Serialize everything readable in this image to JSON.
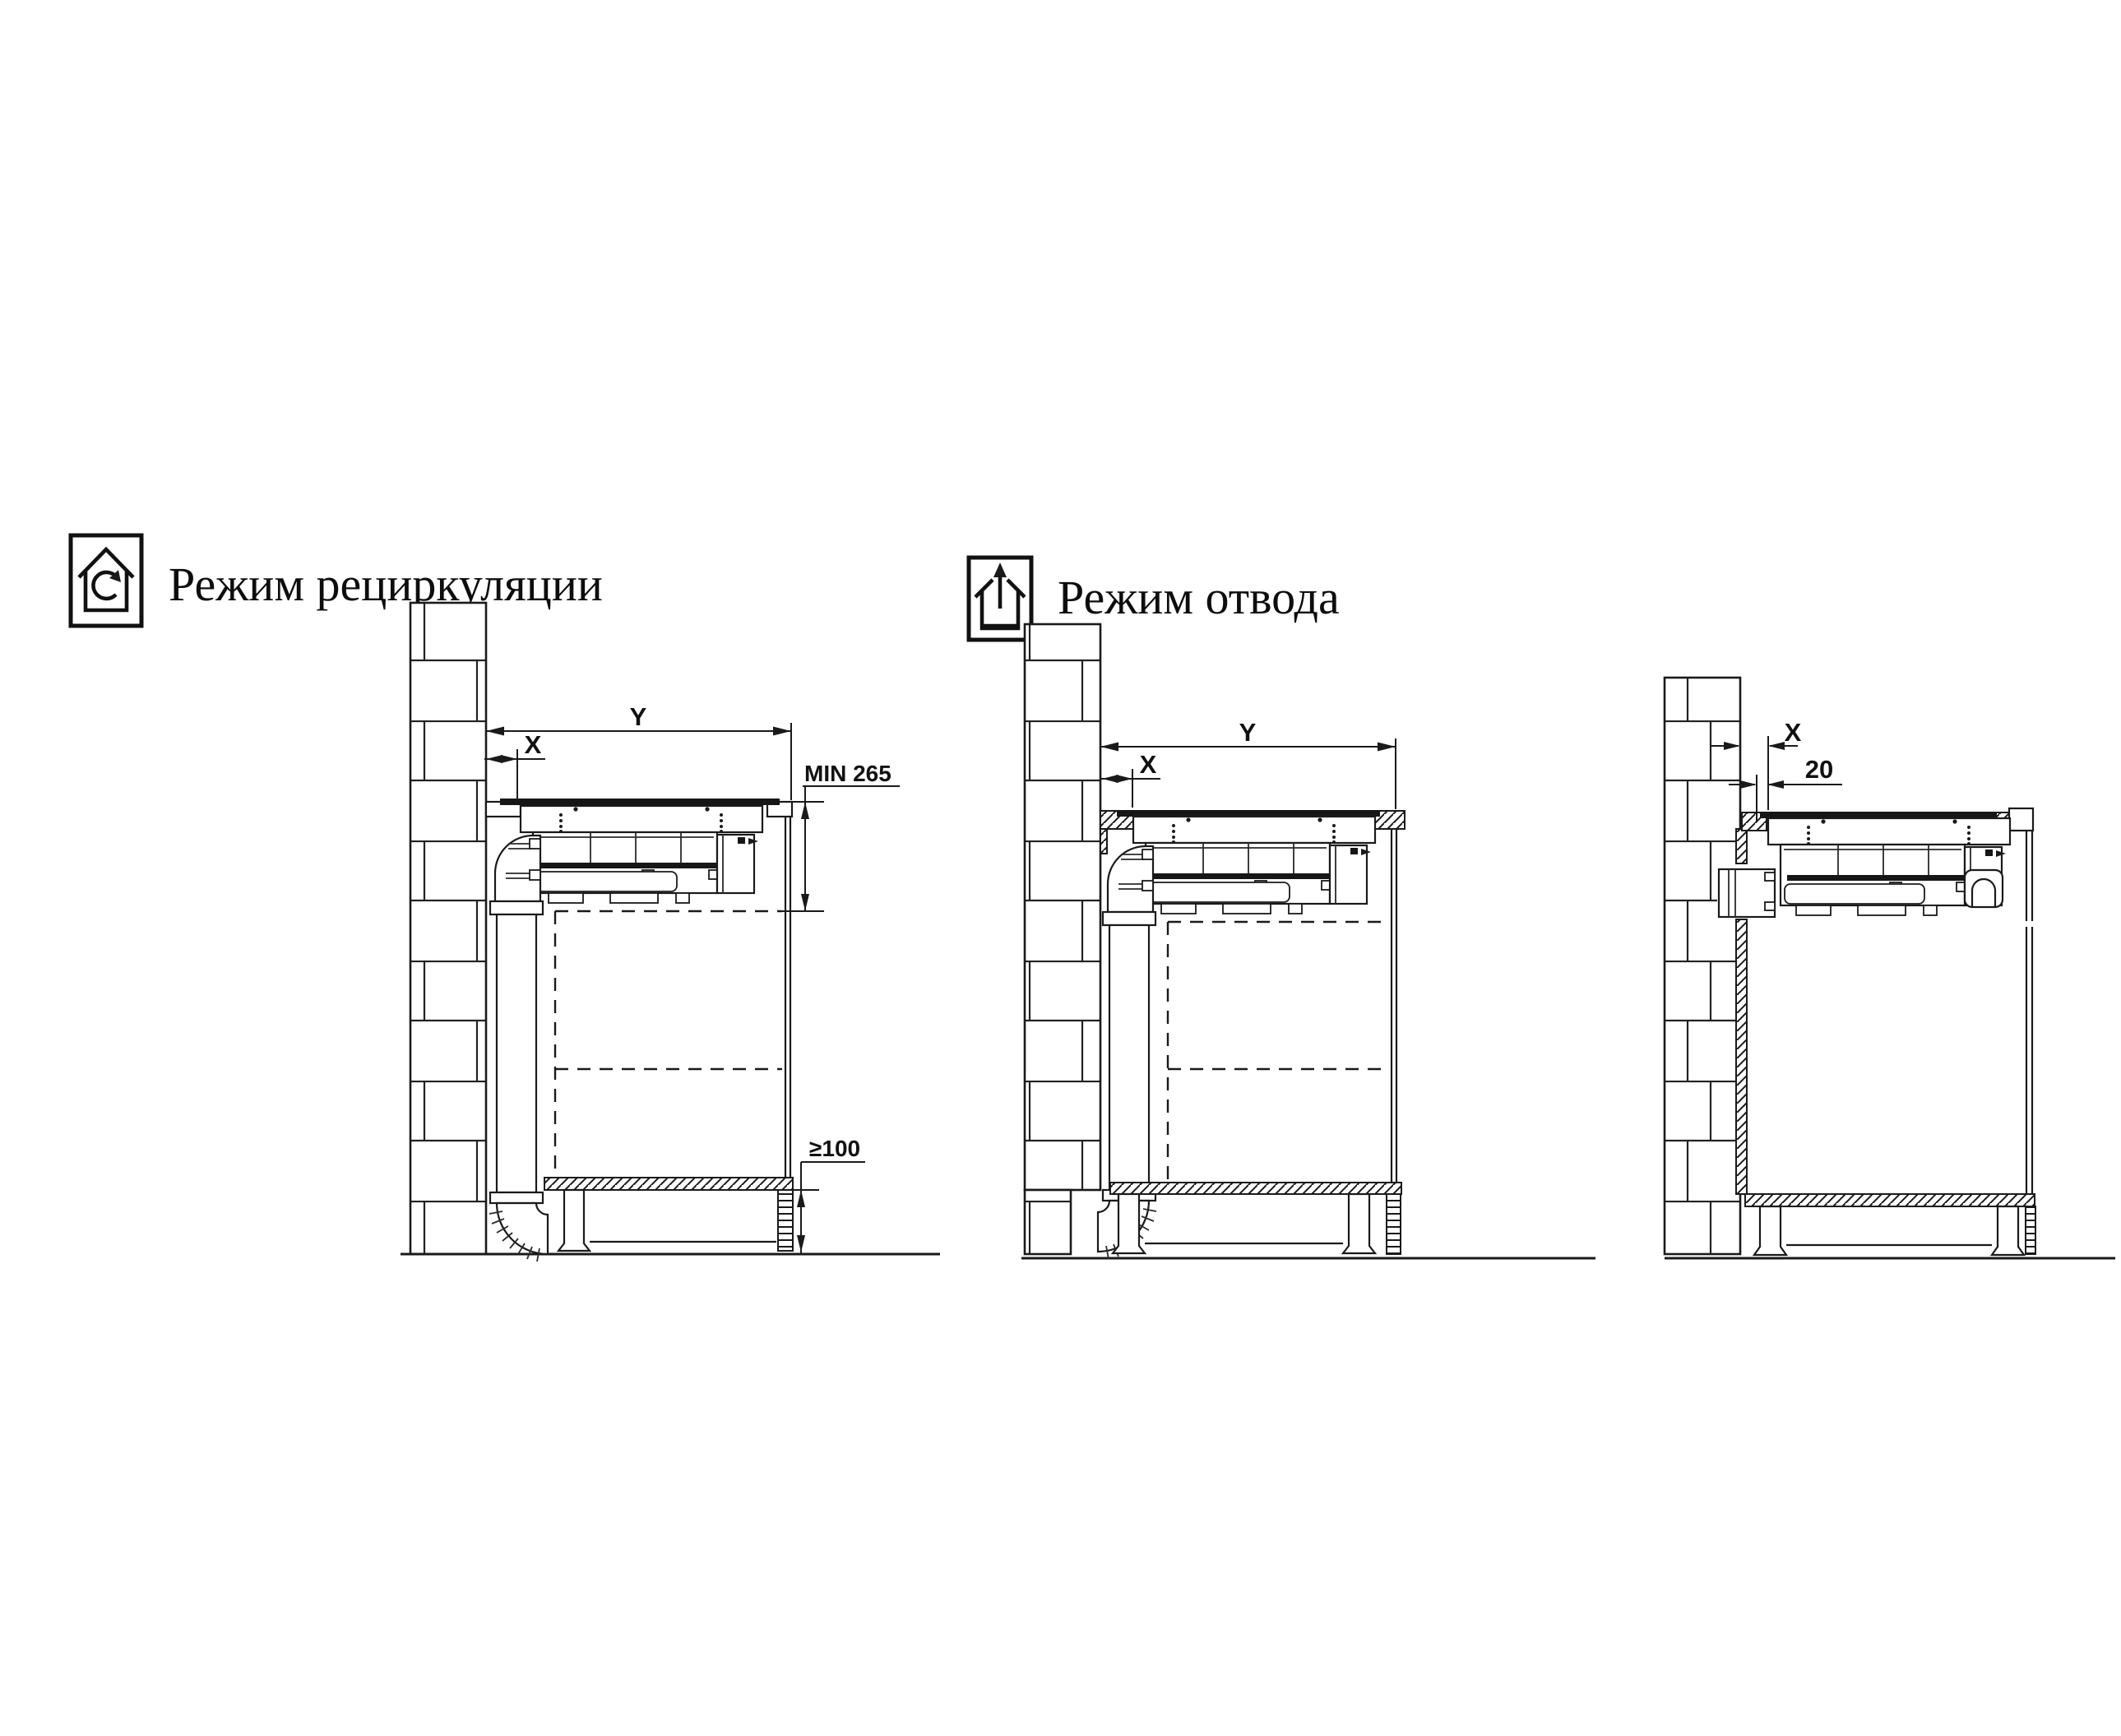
{
  "page": {
    "background": "#ffffff",
    "line_color": "#1a1a1a",
    "kind": "appliance installation drawing"
  },
  "modes": [
    {
      "label": "Режим рециркуляции",
      "icon": "house-recirculation-icon"
    },
    {
      "label": "Режим отвода",
      "icon": "house-exhaust-arrow-icon"
    }
  ],
  "diagrams": [
    {
      "id": "recirculation-through-plinth",
      "dims": {
        "width_total": "Y",
        "wall_offset": "X",
        "min_depth": "MIN 265",
        "plinth_clearance": "≥100"
      }
    },
    {
      "id": "exhaust-duct-through-wall-bottom",
      "dims": {
        "width_total": "Y",
        "wall_offset": "X"
      }
    },
    {
      "id": "exhaust-duct-through-wall-rear",
      "dims": {
        "wall_offset": "X",
        "rear_gap": "20"
      }
    }
  ]
}
